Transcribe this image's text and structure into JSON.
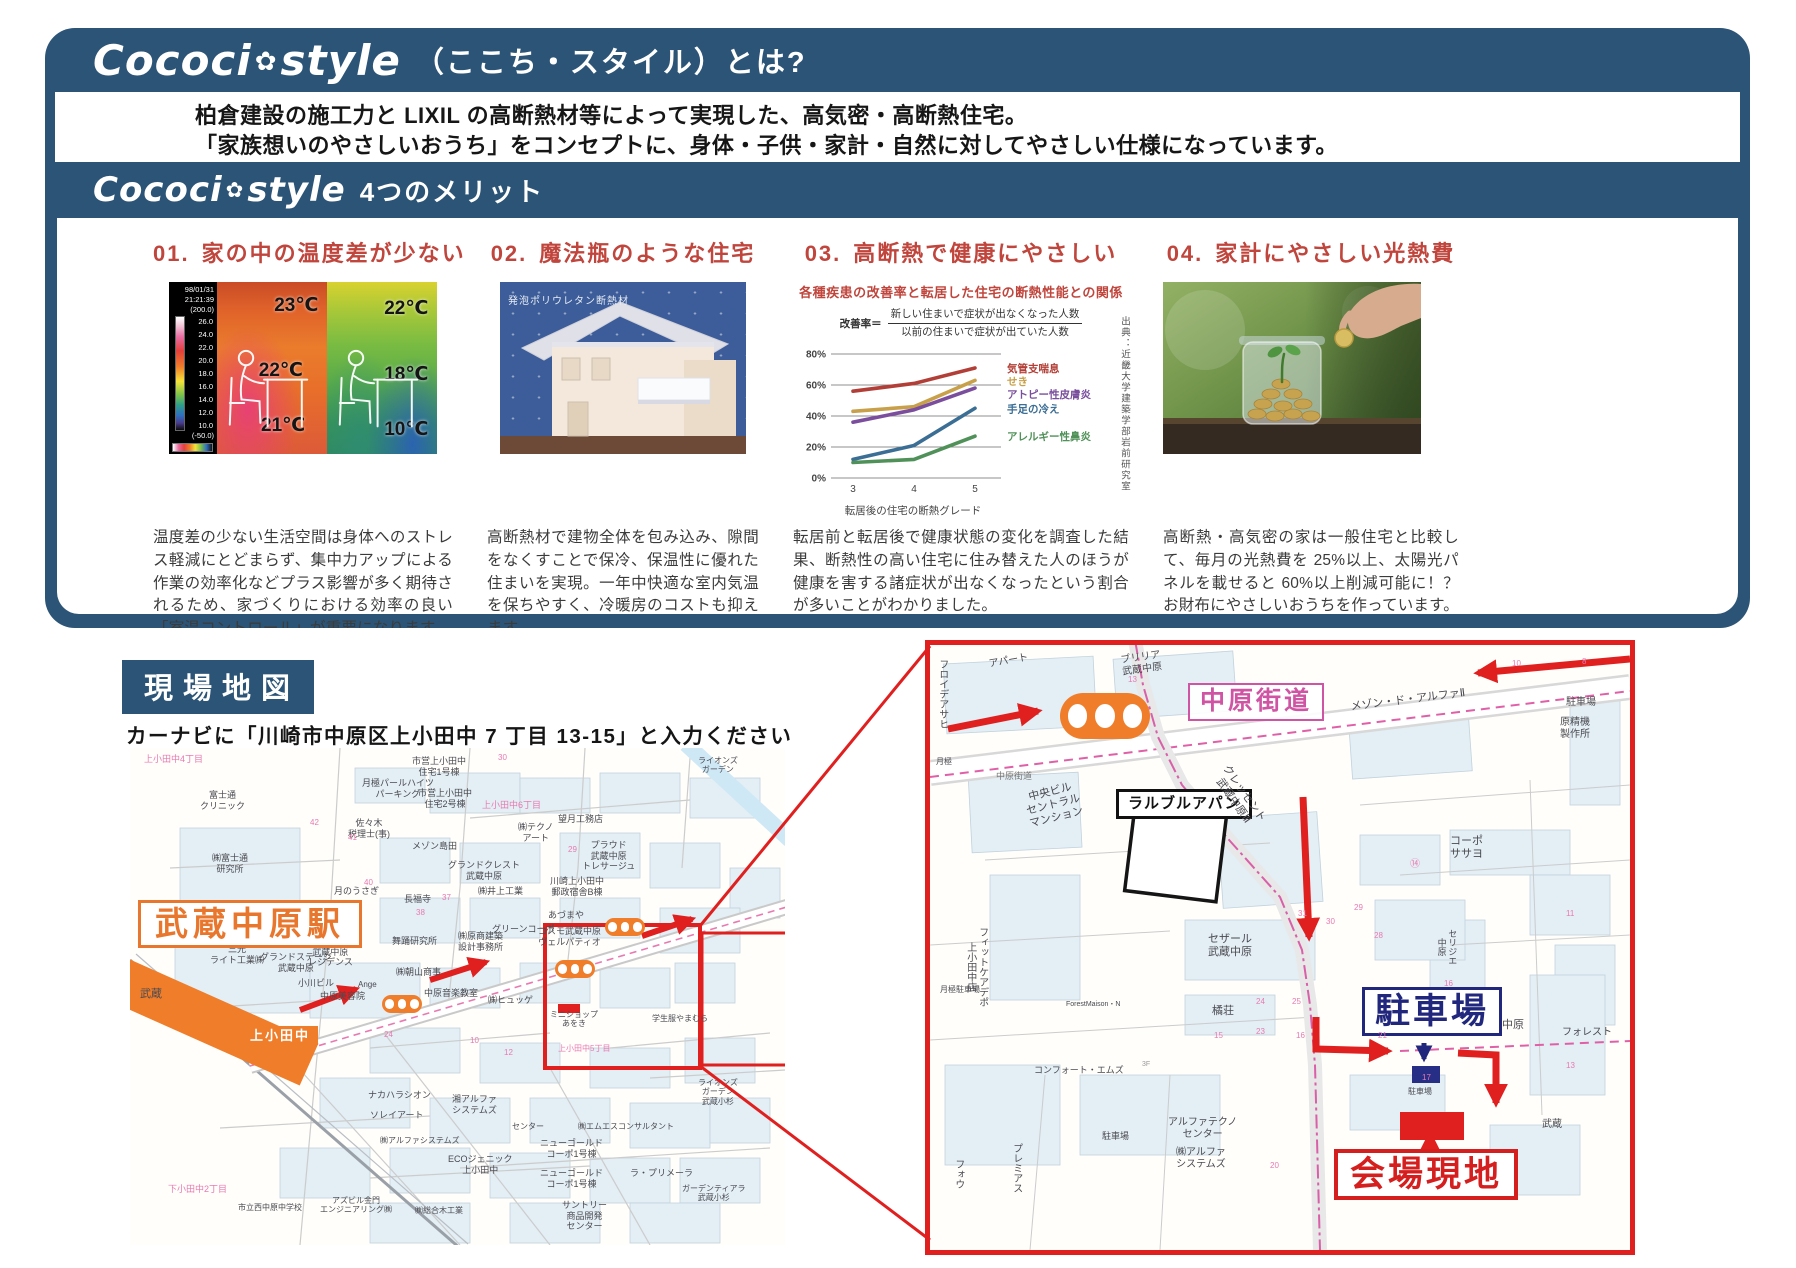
{
  "colors": {
    "panel_blue": "#2b5476",
    "title_red": "#c0453c",
    "map_red": "#e01f1f",
    "orange": "#ef7d2a",
    "road_pink": "#cf55a4",
    "navy": "#20277c"
  },
  "header": {
    "brand_left": "Cococi",
    "brand_flower": "✿",
    "brand_right": "style",
    "title_suffix": "（ここち・スタイル）とは?",
    "intro_lines": [
      "柏倉建設の施工力と LIXIL の高断熱材等によって実現した、高気密・高断熱住宅。",
      "「家族想いのやさしいおうち」をコンセプトに、身体・子供・家計・自然に対してやさしい仕様になっています。"
    ],
    "merits_title": "4つのメリット"
  },
  "merits": [
    {
      "num": "01.",
      "title": "家の中の温度差が少ない",
      "thermal": {
        "date": "98/01/31",
        "time": "21:21:39",
        "top": "(200.0)",
        "scale": [
          "26.0",
          "24.0",
          "22.0",
          "20.0",
          "18.0",
          "16.0",
          "14.0",
          "12.0",
          "10.0"
        ],
        "bottom": "(-50.0)",
        "left_temps": [
          "23℃",
          "22℃",
          "21℃"
        ],
        "right_temps": [
          "22℃",
          "18℃",
          "10℃"
        ]
      },
      "text": "温度差の少ない生活空間は身体へのストレス軽減にとどまらず、集中力アップによる作業の効率化などプラス影響が多く期待されるため、家づくりにおける効率の良い「室温コントロール」が重要になります。"
    },
    {
      "num": "02.",
      "title": "魔法瓶のような住宅",
      "image_label": "発泡ポリウレタン断熱材",
      "text": "高断熱材で建物全体を包み込み、隙間をなくすことで保冷、保温性に優れた住まいを実現。一年中快適な室内気温を保ちやすく、冷暖房のコストも抑えます。"
    },
    {
      "num": "03.",
      "title": "高断熱で健康にやさしい",
      "formula_label": "改善率＝",
      "formula_num": "新しい住まいで症状が出なくなった人数",
      "formula_den": "以前の住まいで症状が出ていた人数",
      "source": "出典：近畿大学建築学部岩前研究室",
      "text": "転居前と転居後で健康状態の変化を調査した結果、断熱性の高い住宅に住み替えた人のほうが健康を害する諸症状が出なくなったという割合が多いことがわかりました。"
    },
    {
      "num": "04.",
      "title": "家計にやさしい光熱費",
      "text": "高断熱・高気密の家は一般住宅と比較して、毎月の光熱費を 25%以上、太陽光パネルを載せると 60%以上削減可能に！？お財布にやさしいおうちを作っています。"
    }
  ],
  "chart_data": {
    "type": "line",
    "title": "各種疾患の改善率と転居した住宅の断熱性能との関係",
    "x": [
      "3",
      "4",
      "5"
    ],
    "xlabel": "転居後の住宅の断熱グレード",
    "ylim": [
      0,
      80
    ],
    "yticks": [
      "0%",
      "20%",
      "40%",
      "60%",
      "80%"
    ],
    "grid": true,
    "legend_position": "right",
    "series": [
      {
        "name": "気管支喘息",
        "color": "#b23f37",
        "values": [
          56,
          61,
          71
        ]
      },
      {
        "name": "せき",
        "color": "#c8a04a",
        "values": [
          43,
          46,
          63
        ]
      },
      {
        "name": "アトピー性皮膚炎",
        "color": "#7a4e9c",
        "values": [
          36,
          44,
          58
        ]
      },
      {
        "name": "手足の冷え",
        "color": "#3b6e94",
        "values": [
          12,
          21,
          45
        ]
      },
      {
        "name": "アレルギー性鼻炎",
        "color": "#4f9158",
        "values": [
          10,
          12,
          27
        ]
      }
    ]
  },
  "map_section": {
    "title": "現場地図",
    "instruction": "カーナビに「川崎市中原区上小田中 7 丁目 13-15」と入力ください",
    "left_map": {
      "labels": [
        {
          "t": "上小田中4丁目",
          "x": 14,
          "y": 6,
          "cls": "lb-pink"
        },
        {
          "t": "ライオンズ\nガーデン",
          "x": 568,
          "y": 8,
          "fs": 8
        },
        {
          "t": "富士通\nクリニック",
          "x": 70,
          "y": 42
        },
        {
          "t": "㈱富士通\n研究所",
          "x": 82,
          "y": 105
        },
        {
          "t": "月極パールハイツ\nパーキング",
          "x": 232,
          "y": 30
        },
        {
          "t": "市営上小田中\n住宅1号棟",
          "x": 282,
          "y": 8
        },
        {
          "t": "市営上小田中\n住宅2号棟",
          "x": 288,
          "y": 40
        },
        {
          "t": "佐々木\n税理士(事)",
          "x": 218,
          "y": 70
        },
        {
          "t": "メゾン島田",
          "x": 282,
          "y": 93
        },
        {
          "t": "グランドクレスト\n武蔵中原",
          "x": 318,
          "y": 112
        },
        {
          "t": "長福寺",
          "x": 274,
          "y": 146
        },
        {
          "t": "㈱井上工業",
          "x": 348,
          "y": 138
        },
        {
          "t": "上小田中6丁目",
          "x": 352,
          "y": 52,
          "cls": "lb-pink"
        },
        {
          "t": "㈱テクノ\nアート",
          "x": 388,
          "y": 74
        },
        {
          "t": "望月工務店",
          "x": 428,
          "y": 66
        },
        {
          "t": "プラウド\n武蔵中原\nトレサージュ",
          "x": 452,
          "y": 92
        },
        {
          "t": "川崎上小田中\n郵政宿舎B棟",
          "x": 420,
          "y": 128
        },
        {
          "t": "あづまや",
          "x": 418,
          "y": 162
        },
        {
          "t": "コスモ武蔵中原\nヴェルパティオ",
          "x": 408,
          "y": 178
        },
        {
          "t": "グリーンコーポ",
          "x": 362,
          "y": 176
        },
        {
          "t": "㈱原商建築\n設計事務所",
          "x": 328,
          "y": 183
        },
        {
          "t": "舞踊研究所",
          "x": 262,
          "y": 188
        },
        {
          "t": "月のうさぎ",
          "x": 204,
          "y": 138
        },
        {
          "t": "居酒屋\nトケビ",
          "x": 184,
          "y": 153
        },
        {
          "t": "イニシア\n武蔵中原\nレジデンス",
          "x": 178,
          "y": 188
        },
        {
          "t": "三光\nライト工業㈱",
          "x": 80,
          "y": 196
        },
        {
          "t": "グランドステージ\n武蔵中原",
          "x": 130,
          "y": 204
        },
        {
          "t": "小川ビル",
          "x": 168,
          "y": 230
        },
        {
          "t": "中原美容院",
          "x": 190,
          "y": 243
        },
        {
          "t": "Ange",
          "x": 228,
          "y": 232,
          "fs": 8
        },
        {
          "t": "㈱朝山商事",
          "x": 266,
          "y": 219
        },
        {
          "t": "中原音楽教室",
          "x": 294,
          "y": 240
        },
        {
          "t": "㈱ヒュッゲ",
          "x": 358,
          "y": 247
        },
        {
          "t": "武蔵",
          "x": 10,
          "y": 240,
          "fs": 11
        },
        {
          "t": "ミニショップ\nあをき",
          "x": 420,
          "y": 262,
          "fs": 8
        },
        {
          "t": "学生服やまむら",
          "x": 522,
          "y": 266,
          "fs": 8
        },
        {
          "t": "上小田中5丁目",
          "x": 428,
          "y": 296,
          "cls": "lb-pink",
          "fs": 8
        },
        {
          "t": "ライオンズ\nガーデン\n武蔵小杉",
          "x": 568,
          "y": 330,
          "fs": 8
        },
        {
          "t": "㈱エムエスコンサルタント",
          "x": 448,
          "y": 374,
          "fs": 8
        },
        {
          "t": "センター",
          "x": 382,
          "y": 374,
          "fs": 8
        },
        {
          "t": "ニューゴールド\nコーポ1号棟",
          "x": 410,
          "y": 390
        },
        {
          "t": "ニューゴールド\nコーポ1号棟",
          "x": 410,
          "y": 420
        },
        {
          "t": "ラ・プリメーラ",
          "x": 500,
          "y": 420
        },
        {
          "t": "ECOジェニック\n上小田中",
          "x": 318,
          "y": 406
        },
        {
          "t": "㈱アルファシステムズ",
          "x": 250,
          "y": 388,
          "fs": 8
        },
        {
          "t": "ナカハラシオン",
          "x": 238,
          "y": 342
        },
        {
          "t": "ソレイアート",
          "x": 240,
          "y": 362
        },
        {
          "t": "湘アルファ\nシステムズ",
          "x": 322,
          "y": 346
        },
        {
          "t": "下小田中2丁目",
          "x": 38,
          "y": 436,
          "cls": "lb-pink"
        },
        {
          "t": "市立西中原中学校",
          "x": 108,
          "y": 455,
          "fs": 8
        },
        {
          "t": "アズビル金門\nエンジニアリング㈱",
          "x": 190,
          "y": 448,
          "fs": 8
        },
        {
          "t": "㈱総合木工業",
          "x": 285,
          "y": 458,
          "fs": 8
        },
        {
          "t": "サントリー\n商品開発\nセンター",
          "x": 432,
          "y": 452
        },
        {
          "t": "ガーデンティアラ\n武蔵小杉",
          "x": 552,
          "y": 436,
          "fs": 8
        },
        {
          "t": "武蔵中原駅",
          "x": 8,
          "y": 152,
          "cls": "lb-orange-big",
          "n": "station-musashi-nakahara-label"
        },
        {
          "t": "上小田中",
          "x": 112,
          "y": 278,
          "cls": "lb-orange-fill",
          "n": "kamiodanaka-label"
        },
        {
          "t": "42",
          "x": 180,
          "y": 70,
          "cls": "lb-pink",
          "fs": 8
        },
        {
          "t": "41",
          "x": 218,
          "y": 85,
          "cls": "lb-pink",
          "fs": 8
        },
        {
          "t": "40",
          "x": 234,
          "y": 130,
          "cls": "lb-pink",
          "fs": 8
        },
        {
          "t": "38",
          "x": 286,
          "y": 160,
          "cls": "lb-pink",
          "fs": 8
        },
        {
          "t": "37",
          "x": 312,
          "y": 145,
          "cls": "lb-pink",
          "fs": 8
        },
        {
          "t": "29",
          "x": 438,
          "y": 97,
          "cls": "lb-pink",
          "fs": 8
        },
        {
          "t": "24",
          "x": 254,
          "y": 282,
          "cls": "lb-pink",
          "fs": 8
        },
        {
          "t": "30",
          "x": 368,
          "y": 5,
          "cls": "lb-pink",
          "fs": 8
        },
        {
          "t": "12",
          "x": 374,
          "y": 300,
          "cls": "lb-pink",
          "fs": 8
        },
        {
          "t": "10",
          "x": 340,
          "y": 288,
          "cls": "lb-pink",
          "fs": 8
        }
      ]
    },
    "right_map": {
      "labels": [
        {
          "t": "フロイデアサヒ",
          "x": 6,
          "y": 14,
          "v": true,
          "fs": 10
        },
        {
          "t": "月極",
          "x": 6,
          "y": 112,
          "fs": 8
        },
        {
          "t": "アパート",
          "x": 58,
          "y": 14,
          "rot": -10,
          "fs": 10
        },
        {
          "t": "ブリリア\n武蔵中原",
          "x": 190,
          "y": 10,
          "rot": -8,
          "fs": 10
        },
        {
          "t": "中原街道",
          "x": 258,
          "y": 38,
          "cls": "lb-pink-box",
          "n": "nakahara-kaido-label"
        },
        {
          "t": "中原街道",
          "x": 66,
          "y": 126,
          "fs": 9,
          "c": "#777"
        },
        {
          "t": "ラルブルアパン",
          "x": 186,
          "y": 144,
          "cls": "lb-black-box",
          "n": "larble-apan-label"
        },
        {
          "t": "中央ビル\nセントラル\nマンション",
          "x": 92,
          "y": 148,
          "rot": -14,
          "fs": 11
        },
        {
          "t": "クレッセント\n武蔵中原Ⅲ",
          "x": 300,
          "y": 118,
          "rot": 55,
          "fs": 11
        },
        {
          "t": "メゾン・ド・アルファⅡ",
          "x": 420,
          "y": 56,
          "rot": -7,
          "fs": 11
        },
        {
          "t": "駐車場",
          "x": 636,
          "y": 52,
          "fs": 10
        },
        {
          "t": "原精機\n製作所",
          "x": 630,
          "y": 72,
          "fs": 10
        },
        {
          "t": "コーポ\nササヨ",
          "x": 520,
          "y": 190,
          "fs": 11
        },
        {
          "t": "セザール\n武蔵中原",
          "x": 278,
          "y": 288,
          "fs": 11
        },
        {
          "t": "橘荘",
          "x": 282,
          "y": 360,
          "fs": 11
        },
        {
          "t": "ForestMaison・N",
          "x": 136,
          "y": 356,
          "fs": 7
        },
        {
          "t": "月極駐車場",
          "x": 10,
          "y": 340,
          "fs": 8
        },
        {
          "t": "フィットケアデポ\n上小田中店",
          "x": 34,
          "y": 282,
          "v": true,
          "fs": 10
        },
        {
          "t": "セリジエ\n中原",
          "x": 506,
          "y": 284,
          "v": true,
          "fs": 9
        },
        {
          "t": "駐車場",
          "x": 432,
          "y": 342,
          "cls": "lb-navy-box",
          "n": "parking-big-label"
        },
        {
          "t": "中原",
          "x": 572,
          "y": 374,
          "fs": 11
        },
        {
          "t": "フォレスト",
          "x": 632,
          "y": 382,
          "fs": 10
        },
        {
          "t": "コンフォート・エムズ",
          "x": 104,
          "y": 420,
          "fs": 9
        },
        {
          "t": "3F",
          "x": 212,
          "y": 416,
          "fs": 7,
          "c": "#999"
        },
        {
          "t": "駐車場",
          "x": 172,
          "y": 486,
          "fs": 9
        },
        {
          "t": "アルファテクノ\nセンター",
          "x": 238,
          "y": 472,
          "fs": 10
        },
        {
          "t": "㈱アルファ\nシステムズ",
          "x": 246,
          "y": 502,
          "fs": 10
        },
        {
          "t": "プレミアス",
          "x": 80,
          "y": 498,
          "v": true,
          "fs": 10
        },
        {
          "t": "フォウ",
          "x": 22,
          "y": 514,
          "v": true,
          "fs": 10
        },
        {
          "t": "会場現地",
          "x": 404,
          "y": 504,
          "cls": "lb-red-box",
          "n": "venue-label"
        },
        {
          "t": "武蔵",
          "x": 612,
          "y": 474,
          "fs": 10
        },
        {
          "t": "駐車場",
          "x": 478,
          "y": 442,
          "fs": 8
        },
        {
          "t": "13",
          "x": 198,
          "y": 30,
          "cls": "lb-pink",
          "fs": 8
        },
        {
          "t": "⑭",
          "x": 480,
          "y": 214,
          "cls": "lb-pink",
          "fs": 10
        },
        {
          "t": "16",
          "x": 514,
          "y": 334,
          "cls": "lb-pink",
          "fs": 8
        },
        {
          "t": "21",
          "x": 448,
          "y": 386,
          "cls": "lb-pink",
          "fs": 8
        },
        {
          "t": "25",
          "x": 362,
          "y": 352,
          "cls": "lb-pink",
          "fs": 8
        },
        {
          "t": "24",
          "x": 326,
          "y": 352,
          "cls": "lb-pink",
          "fs": 8
        },
        {
          "t": "23",
          "x": 326,
          "y": 382,
          "cls": "lb-pink",
          "fs": 8
        },
        {
          "t": "31",
          "x": 368,
          "y": 264,
          "cls": "lb-pink",
          "fs": 8
        },
        {
          "t": "30",
          "x": 396,
          "y": 272,
          "cls": "lb-pink",
          "fs": 8
        },
        {
          "t": "29",
          "x": 424,
          "y": 258,
          "cls": "lb-pink",
          "fs": 8
        },
        {
          "t": "28",
          "x": 444,
          "y": 286,
          "cls": "lb-pink",
          "fs": 8
        },
        {
          "t": "20",
          "x": 340,
          "y": 516,
          "cls": "lb-pink",
          "fs": 8
        },
        {
          "t": "17",
          "x": 492,
          "y": 428,
          "cls": "lb-pink",
          "fs": 8
        },
        {
          "t": "15",
          "x": 284,
          "y": 386,
          "cls": "lb-pink",
          "fs": 8
        },
        {
          "t": "16",
          "x": 366,
          "y": 386,
          "cls": "lb-pink",
          "fs": 8
        },
        {
          "t": "11",
          "x": 636,
          "y": 264,
          "cls": "lb-pink",
          "fs": 8
        },
        {
          "t": "13",
          "x": 636,
          "y": 416,
          "cls": "lb-pink",
          "fs": 8
        },
        {
          "t": "10",
          "x": 582,
          "y": 14,
          "cls": "lb-pink",
          "fs": 8
        },
        {
          "t": "8",
          "x": 652,
          "y": 12,
          "cls": "lb-pink",
          "fs": 8
        }
      ]
    }
  }
}
